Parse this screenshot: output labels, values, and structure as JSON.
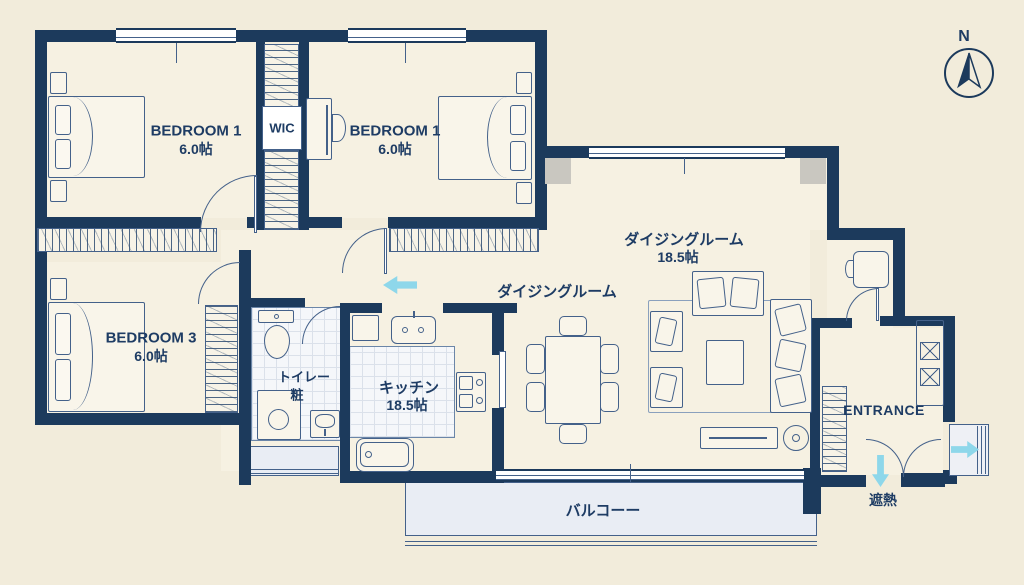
{
  "title": "apartment-floor-plan",
  "colors": {
    "wall": "#1c3a5c",
    "line": "#44618a",
    "background": "#f2ecdb",
    "room_fill": "#f6f1e2",
    "balcony_fill": "#e9edf4",
    "arrow": "#8ed7ea",
    "text": "#1e3c64",
    "pillar": "#c9c7c0"
  },
  "labels": {
    "bedroom1": {
      "name": "BEDROOM 1",
      "area": "6.0帖"
    },
    "bedroom2": {
      "name": "BEDROOM 1",
      "area": "6.0帖"
    },
    "bedroom3": {
      "name": "BEDROOM 3",
      "area": "6.0帖"
    },
    "wic": "WIC",
    "toilet": {
      "line1": "トイレー",
      "line2": "粧"
    },
    "kitchen": {
      "name": "キッチン",
      "area": "18.5帖"
    },
    "dining": {
      "name": "ダイジングルーム",
      "area": "18.5帖"
    },
    "dining_secondary": "ダイジングルーム",
    "entrance": "ENTRANCE",
    "balcony": "バルコーー",
    "heat_shield": "遮熱",
    "compass_north": "N"
  }
}
